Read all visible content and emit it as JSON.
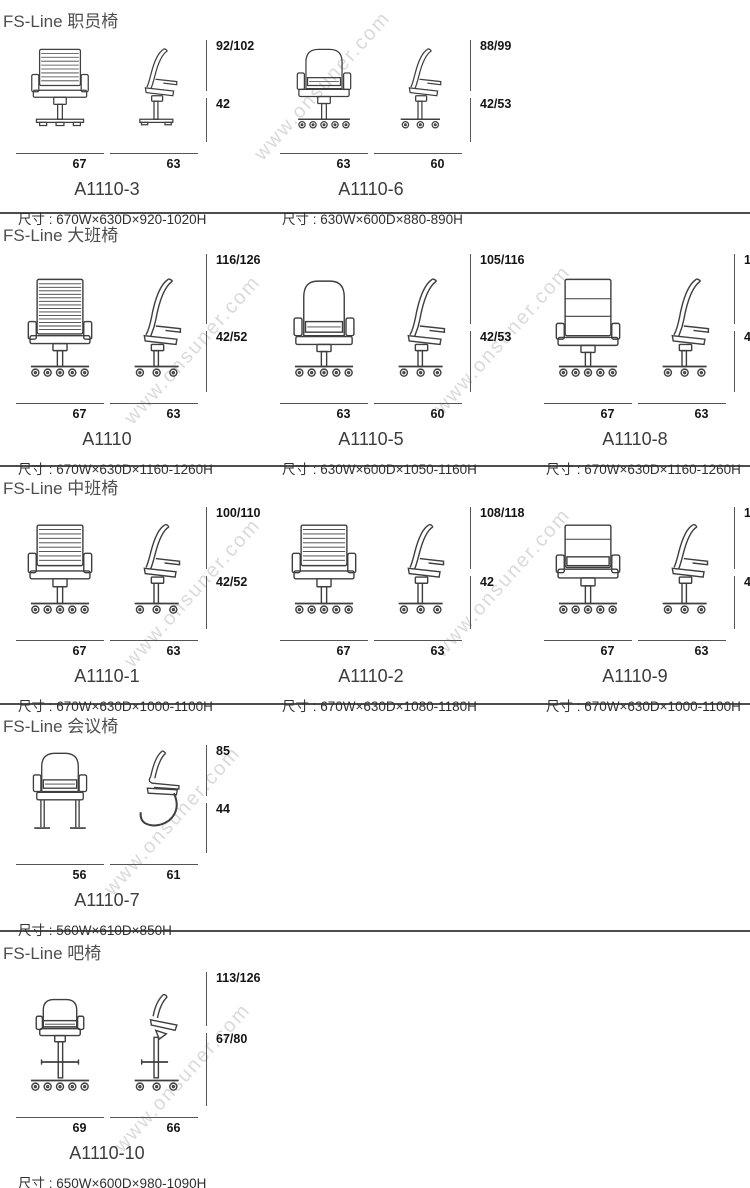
{
  "watermark": "www.onsuner.com",
  "sections": [
    {
      "title": "FS-Line 职员椅",
      "products": [
        {
          "code": "A1110-3",
          "spec": "尺寸 : 670W×630D×920-1020H",
          "front_width": "67",
          "side_width": "63",
          "back_height": "92/102",
          "seat_height": "42"
        },
        {
          "code": "A1110-6",
          "spec": "尺寸 : 630W×600D×880-890H",
          "front_width": "63",
          "side_width": "60",
          "back_height": "88/99",
          "seat_height": "42/53"
        }
      ]
    },
    {
      "title": "FS-Line 大班椅",
      "products": [
        {
          "code": "A1110",
          "spec": "尺寸 : 670W×630D×1160-1260H",
          "front_width": "67",
          "side_width": "63",
          "back_height": "116/126",
          "seat_height": "42/52"
        },
        {
          "code": "A1110-5",
          "spec": "尺寸 : 630W×600D×1050-1160H",
          "front_width": "63",
          "side_width": "60",
          "back_height": "105/116",
          "seat_height": "42/53"
        },
        {
          "code": "A1110-8",
          "spec": "尺寸 : 670W×630D×1160-1260H",
          "front_width": "67",
          "side_width": "63",
          "back_height": "116/126",
          "seat_height": "42/52"
        }
      ]
    },
    {
      "title": "FS-Line 中班椅",
      "products": [
        {
          "code": "A1110-1",
          "spec": "尺寸 : 670W×630D×1000-1100H",
          "front_width": "67",
          "side_width": "63",
          "back_height": "100/110",
          "seat_height": "42/52"
        },
        {
          "code": "A1110-2",
          "spec": "尺寸 : 670W×630D×1080-1180H",
          "front_width": "67",
          "side_width": "63",
          "back_height": "108/118",
          "seat_height": "42"
        },
        {
          "code": "A1110-9",
          "spec": "尺寸 : 670W×630D×1000-1100H",
          "front_width": "67",
          "side_width": "63",
          "back_height": "100/110",
          "seat_height": "42/52"
        }
      ]
    },
    {
      "title": "FS-Line 会议椅",
      "products": [
        {
          "code": "A1110-7",
          "spec": "尺寸 : 560W×610D×850H",
          "front_width": "56",
          "side_width": "61",
          "back_height": "85",
          "seat_height": "44"
        }
      ]
    },
    {
      "title": "FS-Line 吧椅",
      "products": [
        {
          "code": "A1110-10",
          "spec": "尺寸 : 650W×600D×980-1090H",
          "front_width": "69",
          "side_width": "66",
          "back_height": "113/126",
          "seat_height": "67/80"
        }
      ]
    }
  ]
}
